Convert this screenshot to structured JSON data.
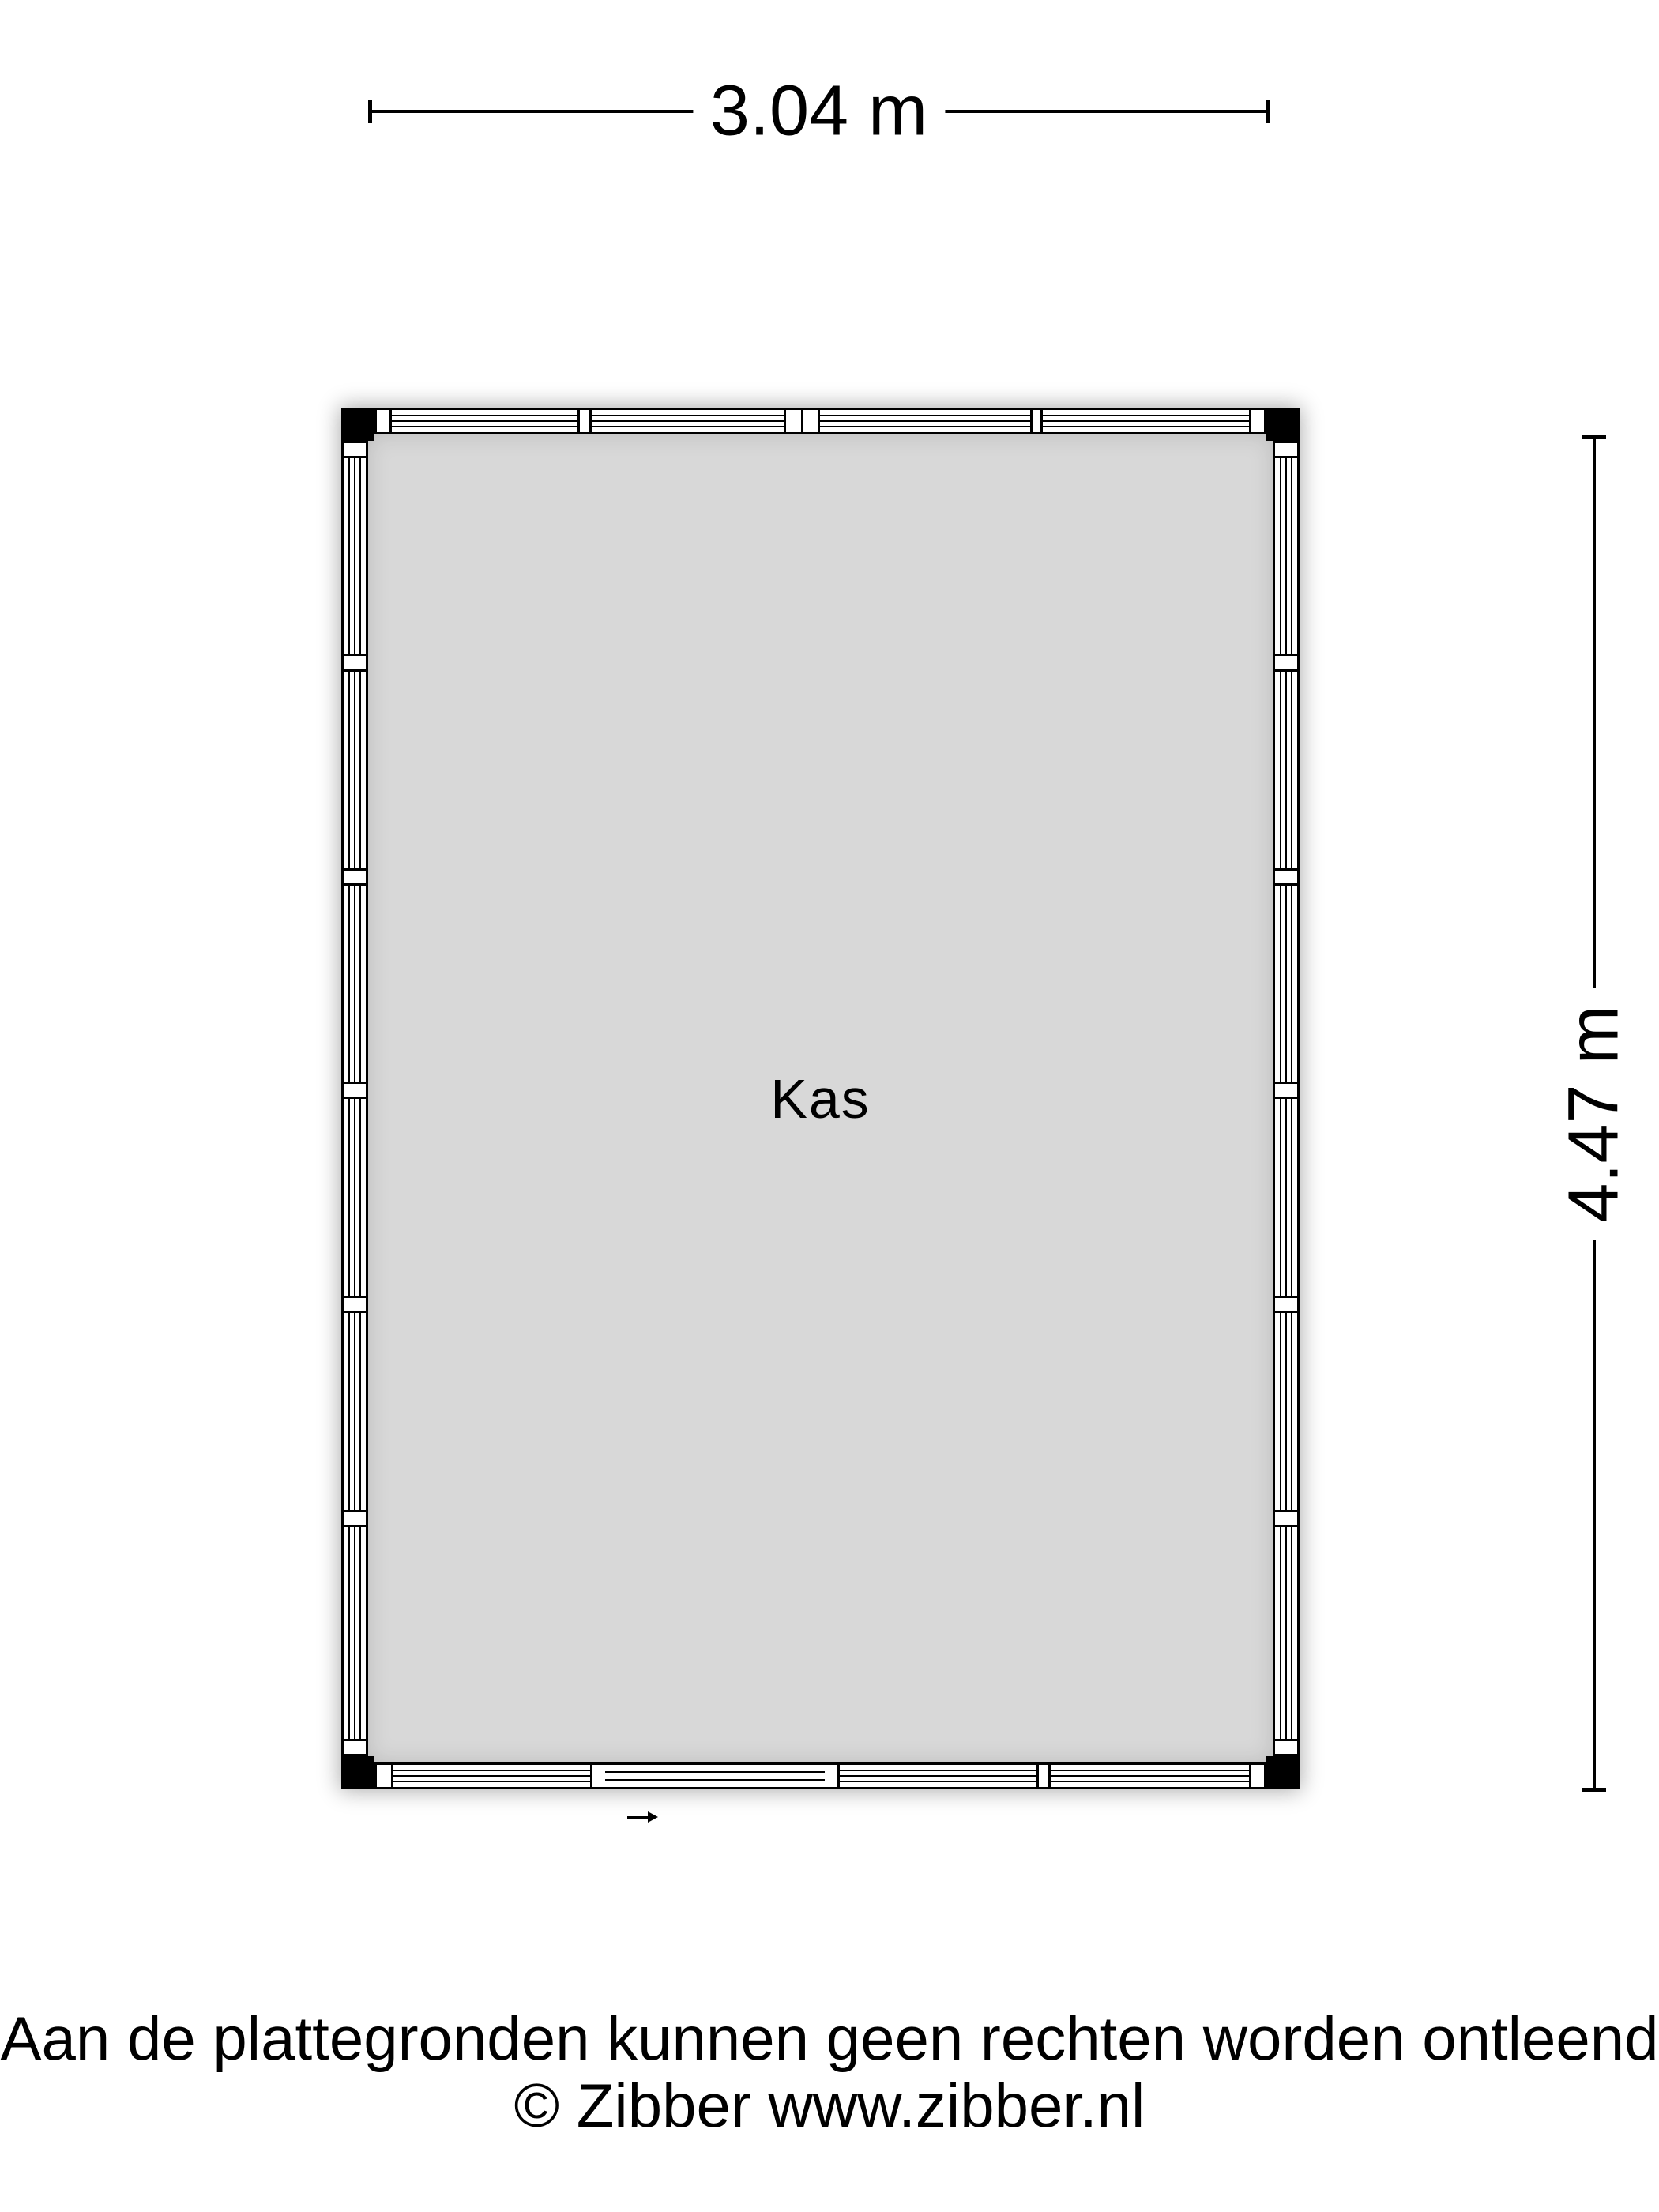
{
  "plan": {
    "room_label": "Kas",
    "width_dimension": "3.04 m",
    "height_dimension": "4.47 m"
  },
  "footer": {
    "disclaimer": "Aan de plattegronden kunnen geen rechten worden ontleend",
    "copyright": "© Zibber www.zibber.nl"
  },
  "icons": {
    "entrance_arrow": "right-arrow"
  },
  "colors": {
    "floor_fill": "#d8d8d8",
    "wall_fill": "#ffffff",
    "line_color": "#000000",
    "shadow": "rgba(0,0,0,0.33)"
  }
}
